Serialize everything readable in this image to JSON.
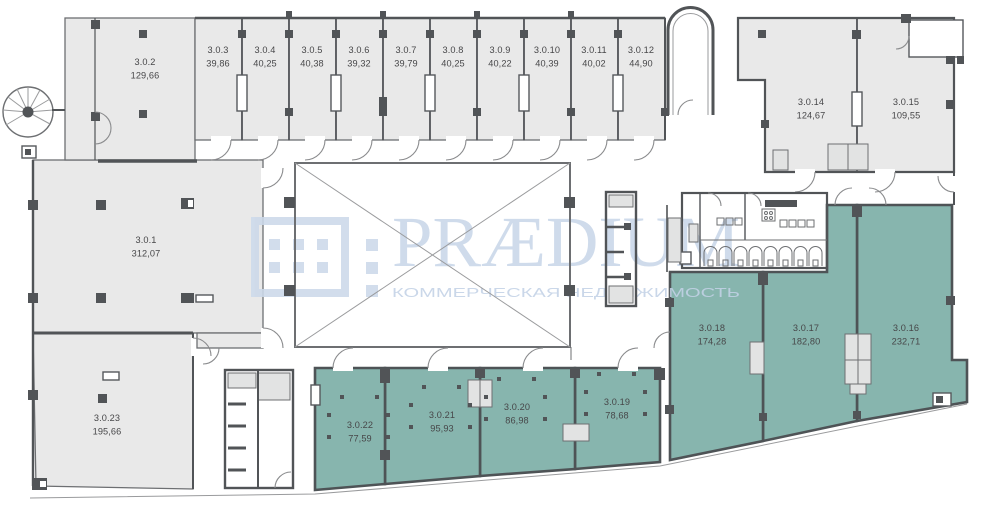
{
  "watermark": {
    "brand": "PRÆDIUM",
    "tagline": "КОММЕРЧЕСКАЯ НЕДВИЖИМОСТЬ",
    "color": "#ccd9ea"
  },
  "colors": {
    "gray_room": "#e9e9e9",
    "teal_room": "#87b5ae",
    "wall_dark": "#515457",
    "wall_mid": "#6d6f72",
    "wall_light": "#9a9b9d",
    "shaft_gray": "#e2e3e3",
    "label": "#474749"
  },
  "rooms": [
    {
      "id": "3.0.1",
      "area": "312,07",
      "type": "gray"
    },
    {
      "id": "3.0.2",
      "area": "129,66",
      "type": "gray"
    },
    {
      "id": "3.0.3",
      "area": "39,86",
      "type": "gray"
    },
    {
      "id": "3.0.4",
      "area": "40,25",
      "type": "gray"
    },
    {
      "id": "3.0.5",
      "area": "40,38",
      "type": "gray"
    },
    {
      "id": "3.0.6",
      "area": "39,32",
      "type": "gray"
    },
    {
      "id": "3.0.7",
      "area": "39,79",
      "type": "gray"
    },
    {
      "id": "3.0.8",
      "area": "40,25",
      "type": "gray"
    },
    {
      "id": "3.0.9",
      "area": "40,22",
      "type": "gray"
    },
    {
      "id": "3.0.10",
      "area": "40,39",
      "type": "gray"
    },
    {
      "id": "3.0.11",
      "area": "40,02",
      "type": "gray"
    },
    {
      "id": "3.0.12",
      "area": "44,90",
      "type": "gray"
    },
    {
      "id": "3.0.14",
      "area": "124,67",
      "type": "gray"
    },
    {
      "id": "3.0.15",
      "area": "109,55",
      "type": "gray"
    },
    {
      "id": "3.0.16",
      "area": "232,71",
      "type": "teal"
    },
    {
      "id": "3.0.17",
      "area": "182,80",
      "type": "teal"
    },
    {
      "id": "3.0.18",
      "area": "174,28",
      "type": "teal"
    },
    {
      "id": "3.0.19",
      "area": "78,68",
      "type": "teal"
    },
    {
      "id": "3.0.20",
      "area": "86,98",
      "type": "teal"
    },
    {
      "id": "3.0.21",
      "area": "95,93",
      "type": "teal"
    },
    {
      "id": "3.0.22",
      "area": "77,59",
      "type": "teal"
    },
    {
      "id": "3.0.23",
      "area": "195,66",
      "type": "gray"
    }
  ]
}
